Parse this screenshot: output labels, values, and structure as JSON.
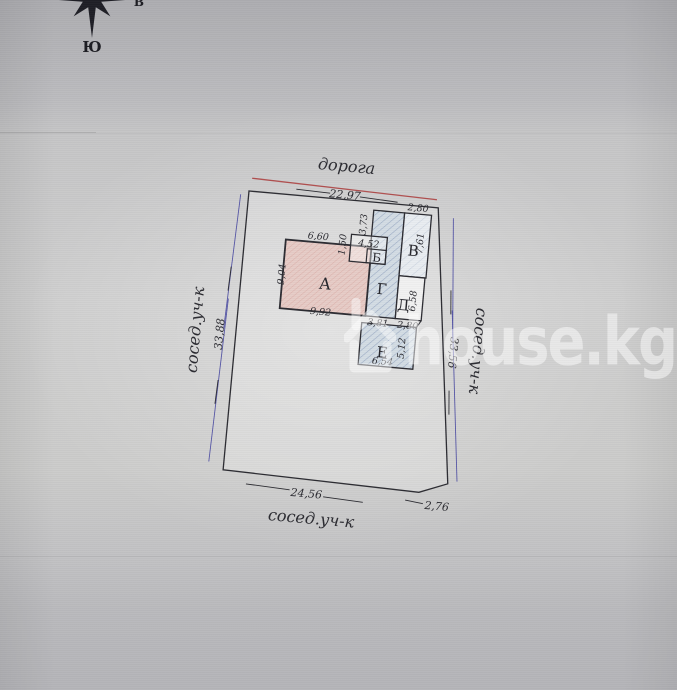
{
  "compass": {
    "south_label": "Ю",
    "east_label": "В"
  },
  "watermark": {
    "text": "house.kg"
  },
  "plan": {
    "road_label": "дорога",
    "boundaries": {
      "top": {
        "length": "22,97"
      },
      "left": {
        "length": "33,88",
        "neighbor": "сосед.уч-к"
      },
      "right": {
        "length": "33,56",
        "neighbor": "сосед.уч-к"
      },
      "bottom": {
        "length": "24,56",
        "corner": "2,76",
        "neighbor": "сосед.уч-к"
      }
    },
    "buildings": {
      "a": {
        "label": "А",
        "top": "6,60",
        "left": "9,04",
        "bottom": "9,92"
      },
      "b": {
        "label": "Б",
        "top": "4,52",
        "offset": "1,50"
      },
      "v": {
        "label": "В",
        "top": "2,80",
        "right": "7,61"
      },
      "g": {
        "label": "Г",
        "top": "3,73",
        "bottom": "3,81"
      },
      "d": {
        "label": "Д",
        "right": "6,58",
        "bottom": "2,80"
      },
      "e": {
        "label": "Е",
        "right": "5,12",
        "bottom": "6,54"
      }
    },
    "colors": {
      "ink": "#2c2c32",
      "boundary_blue": "#5656a6",
      "road_red": "#b04f4f",
      "building_pink": "#e7ccc7",
      "building_blue": "#d3dce4"
    }
  }
}
